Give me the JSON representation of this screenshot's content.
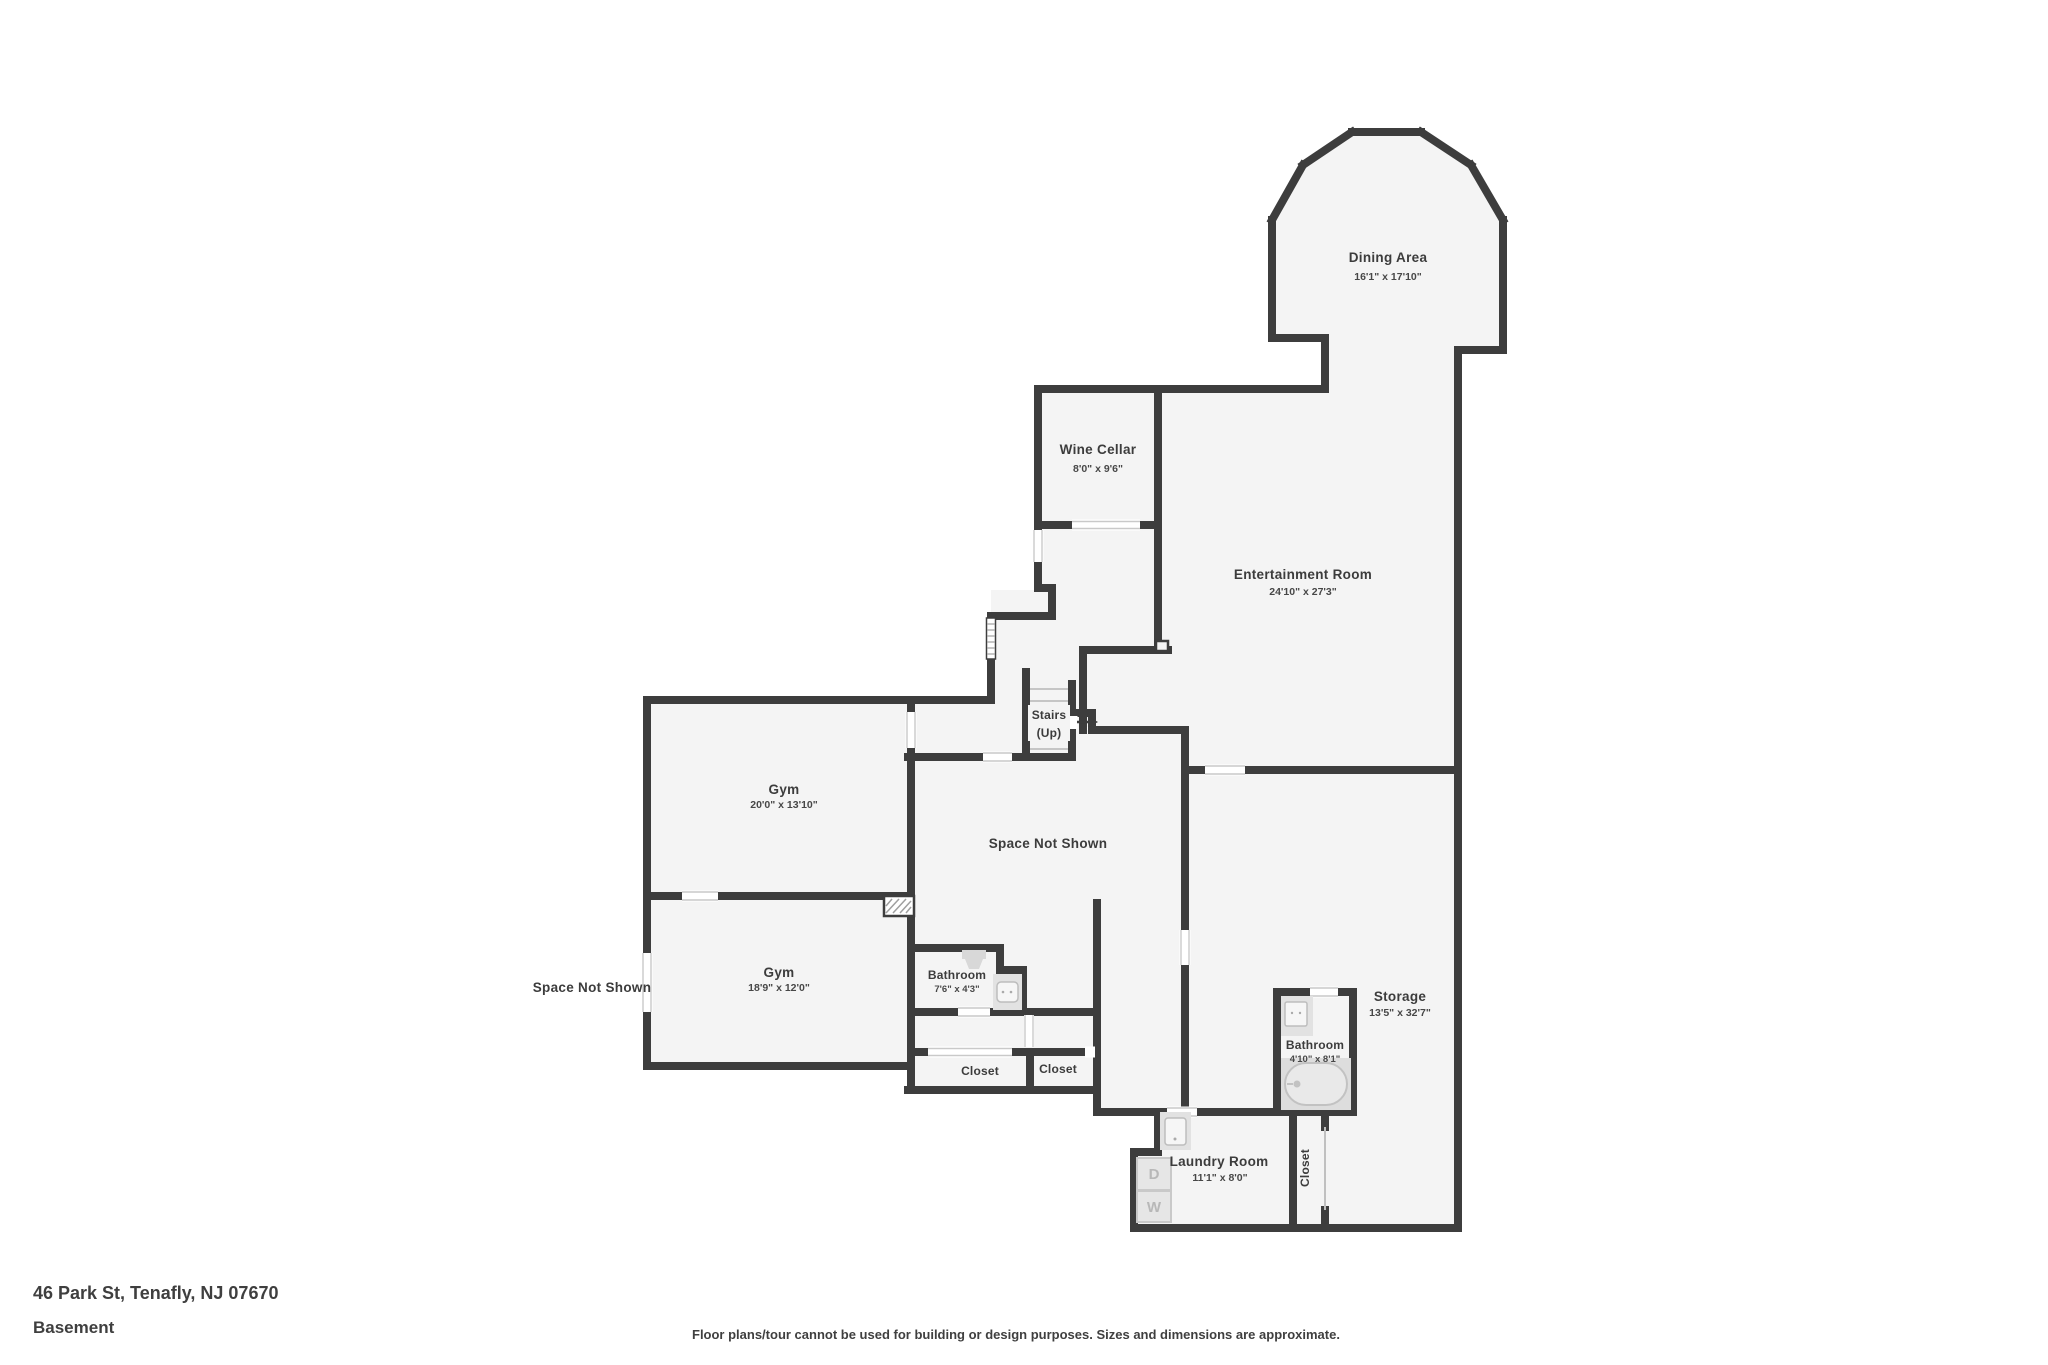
{
  "colors": {
    "wall": "#3d3d3d",
    "floor": "#f4f4f4",
    "fixture_pad": "#e2e2e2",
    "label": "#3c3c3c",
    "background": "#ffffff"
  },
  "rooms": {
    "dining": {
      "name": "Dining Area",
      "dims": "16'1\" x 17'10\""
    },
    "wine_cellar": {
      "name": "Wine Cellar",
      "dims": "8'0\" x 9'6\""
    },
    "entertainment": {
      "name": "Entertainment Room",
      "dims": "24'10\" x 27'3\""
    },
    "stairs": {
      "name": "Stairs",
      "sub": "(Up)"
    },
    "gym_upper": {
      "name": "Gym",
      "dims": "20'0\" x 13'10\""
    },
    "gym_lower": {
      "name": "Gym",
      "dims": "18'9\" x 12'0\""
    },
    "space_center": {
      "name": "Space Not Shown"
    },
    "space_left": {
      "name": "Space Not Shown"
    },
    "bathroom_small": {
      "name": "Bathroom",
      "dims": "7'6\" x 4'3\""
    },
    "bathroom_large": {
      "name": "Bathroom",
      "dims": "4'10\" x 8'1\""
    },
    "storage": {
      "name": "Storage",
      "dims": "13'5\" x 32'7\""
    },
    "laundry": {
      "name": "Laundry Room",
      "dims": "11'1\" x 8'0\"",
      "dryer_label": "D",
      "washer_label": "W"
    },
    "closet_left": {
      "name": "Closet"
    },
    "closet_right": {
      "name": "Closet"
    },
    "closet_vertical": {
      "name": "Closet"
    }
  },
  "footer": {
    "address": "46 Park St, Tenafly, NJ 07670",
    "level": "Basement",
    "disclaimer": "Floor plans/tour cannot be used for building or design purposes. Sizes and dimensions are approximate."
  }
}
